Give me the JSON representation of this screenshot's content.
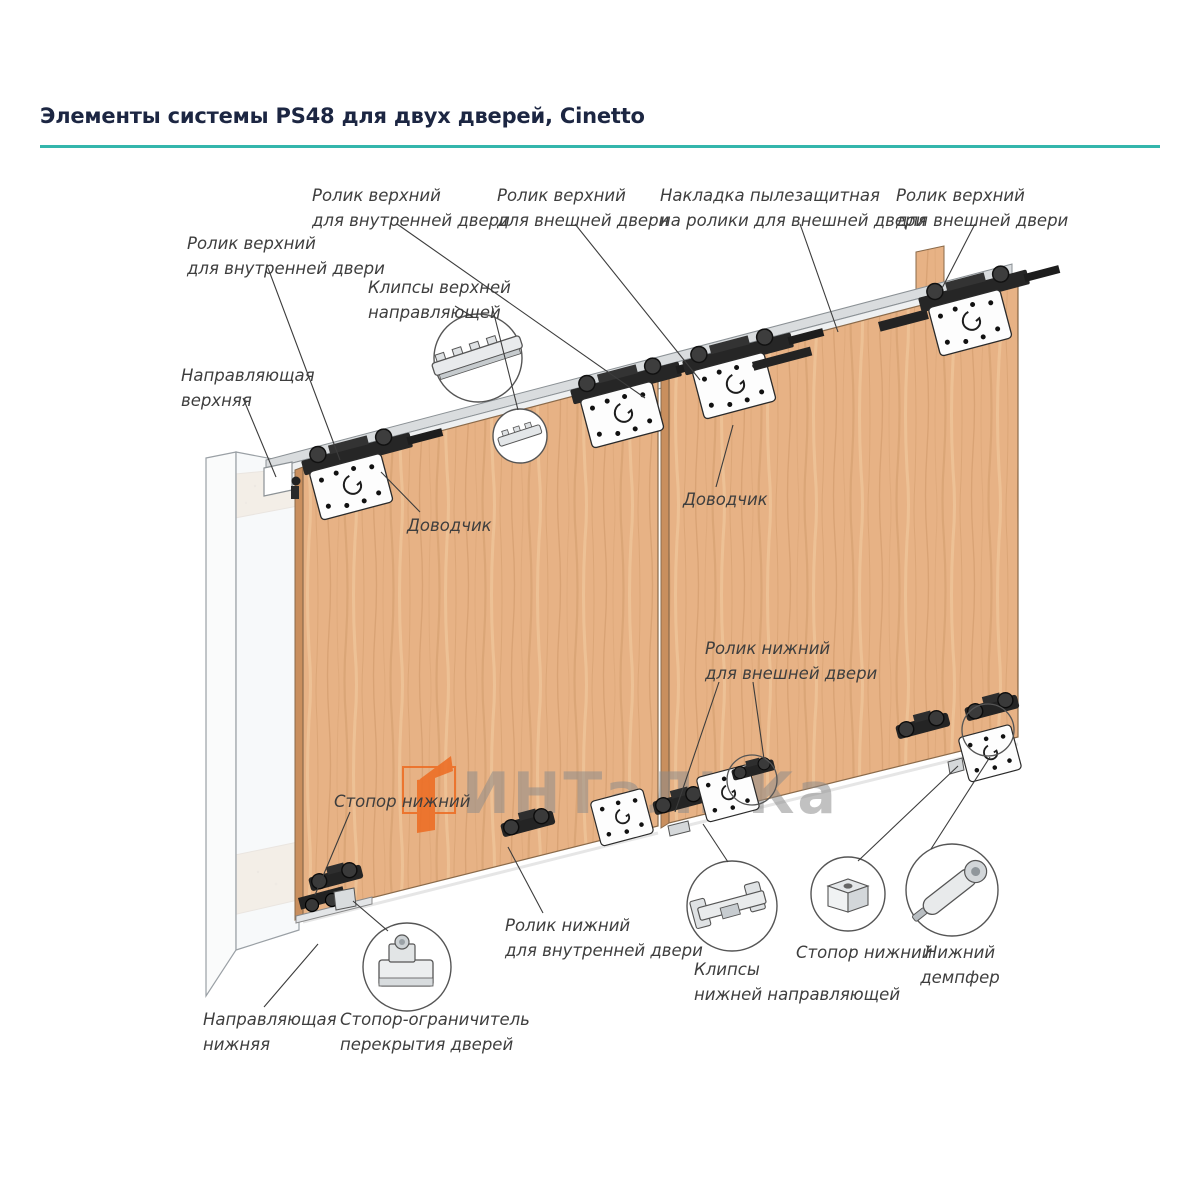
{
  "page": {
    "title": "Элементы системы PS48 для двух дверей, Cinetto",
    "accent_color": "#34b6ac"
  },
  "watermark": {
    "text": "ИНТаЛИКа",
    "text_color": "#8c8c8c",
    "logo_color": "#ed6b21"
  },
  "diagram": {
    "door_color": "#e7b285",
    "labels": [
      {
        "id": "top-roller-inner-right",
        "text": "Ролик верхний\nдля внутренней двери"
      },
      {
        "id": "top-roller-outer-mid",
        "text": "Ролик верхний\nдля внешней двери"
      },
      {
        "id": "dust-cover",
        "text": "Накладка пылезащитная\nна ролики для внешней двери"
      },
      {
        "id": "top-roller-outer-right",
        "text": "Ролик верхний\nдля внешней двери"
      },
      {
        "id": "top-roller-inner-left",
        "text": "Ролик верхний\nдля внутренней двери"
      },
      {
        "id": "top-guide-clips",
        "text": "Клипсы верхней\nнаправляющей"
      },
      {
        "id": "top-guide",
        "text": "Направляющая\nверхняя"
      },
      {
        "id": "closer-left",
        "text": "Доводчик"
      },
      {
        "id": "closer-right",
        "text": "Доводчик"
      },
      {
        "id": "bottom-roller-outer",
        "text": "Ролик нижний\nдля внешней двери"
      },
      {
        "id": "bottom-stopper-mid",
        "text": "Стопор нижний"
      },
      {
        "id": "bottom-roller-inner",
        "text": "Ролик нижний\nдля внутренней двери"
      },
      {
        "id": "bottom-guide-clips",
        "text": "Клипсы\nнижней направляющей"
      },
      {
        "id": "bottom-stopper-right",
        "text": "Стопор нижний"
      },
      {
        "id": "bottom-damper",
        "text": "Нижний\nдемпфер"
      },
      {
        "id": "bottom-guide",
        "text": "Направляющая\nнижняя"
      },
      {
        "id": "overlap-stop-limiter",
        "text": "Стопор-ограничитель\nперекрытия дверей"
      }
    ]
  }
}
